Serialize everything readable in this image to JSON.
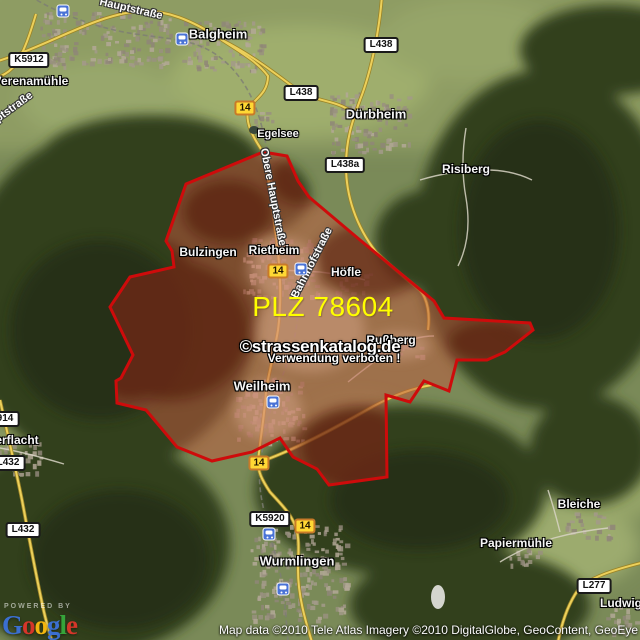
{
  "map": {
    "plz_label": "PLZ 78604",
    "watermark": {
      "line1": "©strassenkatalog.de",
      "line2": "Verwendung verboten !"
    },
    "attribution": "Map data ©2010 Tele Atlas  Imagery ©2010 DigitalGlobe, GeoContent, GeoEye",
    "logo": {
      "powered_by": "POWERED BY",
      "letters": [
        {
          "ch": "G",
          "color": "#3b6fd0"
        },
        {
          "ch": "o",
          "color": "#d5362a"
        },
        {
          "ch": "o",
          "color": "#f2b50f"
        },
        {
          "ch": "g",
          "color": "#3b6fd0"
        },
        {
          "ch": "l",
          "color": "#36a33a"
        },
        {
          "ch": "e",
          "color": "#d5362a"
        }
      ]
    },
    "towns": [
      {
        "label": "Balgheim",
        "x": 218,
        "y": 34,
        "size": 13
      },
      {
        "label": "Dürbheim",
        "x": 376,
        "y": 114,
        "size": 13
      },
      {
        "label": "Wurmlingen",
        "x": 297,
        "y": 561,
        "size": 13
      },
      {
        "label": "Weilheim",
        "x": 262,
        "y": 386,
        "size": 13
      },
      {
        "label": "Rietheim",
        "x": 274,
        "y": 250,
        "size": 12
      },
      {
        "label": "Bulzingen",
        "x": 208,
        "y": 252,
        "size": 12
      },
      {
        "label": "Höfle",
        "x": 346,
        "y": 272,
        "size": 12
      },
      {
        "label": "Rußberg",
        "x": 391,
        "y": 340,
        "size": 12
      },
      {
        "label": "Risiberg",
        "x": 466,
        "y": 169,
        "size": 12
      },
      {
        "label": "Verenamühle",
        "x": 31,
        "y": 81,
        "size": 12
      },
      {
        "label": "Egelsee",
        "x": 278,
        "y": 134,
        "size": 11
      },
      {
        "label": "Bleiche",
        "x": 579,
        "y": 504,
        "size": 12
      },
      {
        "label": "Papiermühle",
        "x": 516,
        "y": 543,
        "size": 12
      },
      {
        "label": "erflacht",
        "x": 17,
        "y": 440,
        "size": 12
      },
      {
        "label": "Ludwig",
        "x": 621,
        "y": 603,
        "size": 12
      }
    ],
    "road_names": [
      {
        "label": "Hauptstraße",
        "x": 131,
        "y": 9,
        "rot": 13
      },
      {
        "label": "ptstraße",
        "x": 14,
        "y": 107,
        "rot": -36
      },
      {
        "label": "Obere Hauptstraße",
        "x": 273,
        "y": 197,
        "rot": 79
      },
      {
        "label": "Bahnhofstraße",
        "x": 312,
        "y": 263,
        "rot": -63
      }
    ],
    "shields": [
      {
        "label": "K5912",
        "x": 29,
        "y": 60
      },
      {
        "label": "L438",
        "x": 301,
        "y": 93
      },
      {
        "label": "L438",
        "x": 381,
        "y": 45
      },
      {
        "label": "L438a",
        "x": 345,
        "y": 165
      },
      {
        "label": "914",
        "x": 5,
        "y": 419
      },
      {
        "label": "L432",
        "x": 8,
        "y": 463
      },
      {
        "label": "L432",
        "x": 23,
        "y": 530
      },
      {
        "label": "K5920",
        "x": 270,
        "y": 519
      },
      {
        "label": "L277",
        "x": 594,
        "y": 586
      }
    ],
    "route_badges": [
      {
        "label": "14",
        "x": 245,
        "y": 108
      },
      {
        "label": "14",
        "x": 278,
        "y": 271
      },
      {
        "label": "14",
        "x": 259,
        "y": 463
      },
      {
        "label": "14",
        "x": 305,
        "y": 526
      }
    ],
    "stations": [
      {
        "x": 63,
        "y": 11
      },
      {
        "x": 182,
        "y": 39
      },
      {
        "x": 301,
        "y": 269
      },
      {
        "x": 273,
        "y": 402
      },
      {
        "x": 269,
        "y": 534
      },
      {
        "x": 283,
        "y": 589
      }
    ],
    "settlements": [
      {
        "x": 105,
        "y": 38,
        "w": 130,
        "h": 55
      },
      {
        "x": 222,
        "y": 45,
        "w": 80,
        "h": 50
      },
      {
        "x": 368,
        "y": 122,
        "w": 80,
        "h": 60
      },
      {
        "x": 280,
        "y": 268,
        "w": 75,
        "h": 60
      },
      {
        "x": 268,
        "y": 410,
        "w": 70,
        "h": 65
      },
      {
        "x": 298,
        "y": 572,
        "w": 95,
        "h": 95
      },
      {
        "x": 352,
        "y": 282,
        "w": 35,
        "h": 22
      },
      {
        "x": 398,
        "y": 347,
        "w": 45,
        "h": 18
      },
      {
        "x": 588,
        "y": 525,
        "w": 45,
        "h": 28
      },
      {
        "x": 522,
        "y": 558,
        "w": 32,
        "h": 20
      },
      {
        "x": 18,
        "y": 458,
        "w": 45,
        "h": 35
      },
      {
        "x": 622,
        "y": 618,
        "w": 35,
        "h": 30
      },
      {
        "x": 262,
        "y": 120,
        "w": 25,
        "h": 18
      }
    ],
    "colors": {
      "region_border": "#ce0b0b",
      "region_fill": "#c05a40",
      "badge_bg": "#ffd834",
      "badge_border": "#c87a28",
      "plz_yellow": "#ffff00",
      "station_blue": "#4a73d6"
    }
  }
}
